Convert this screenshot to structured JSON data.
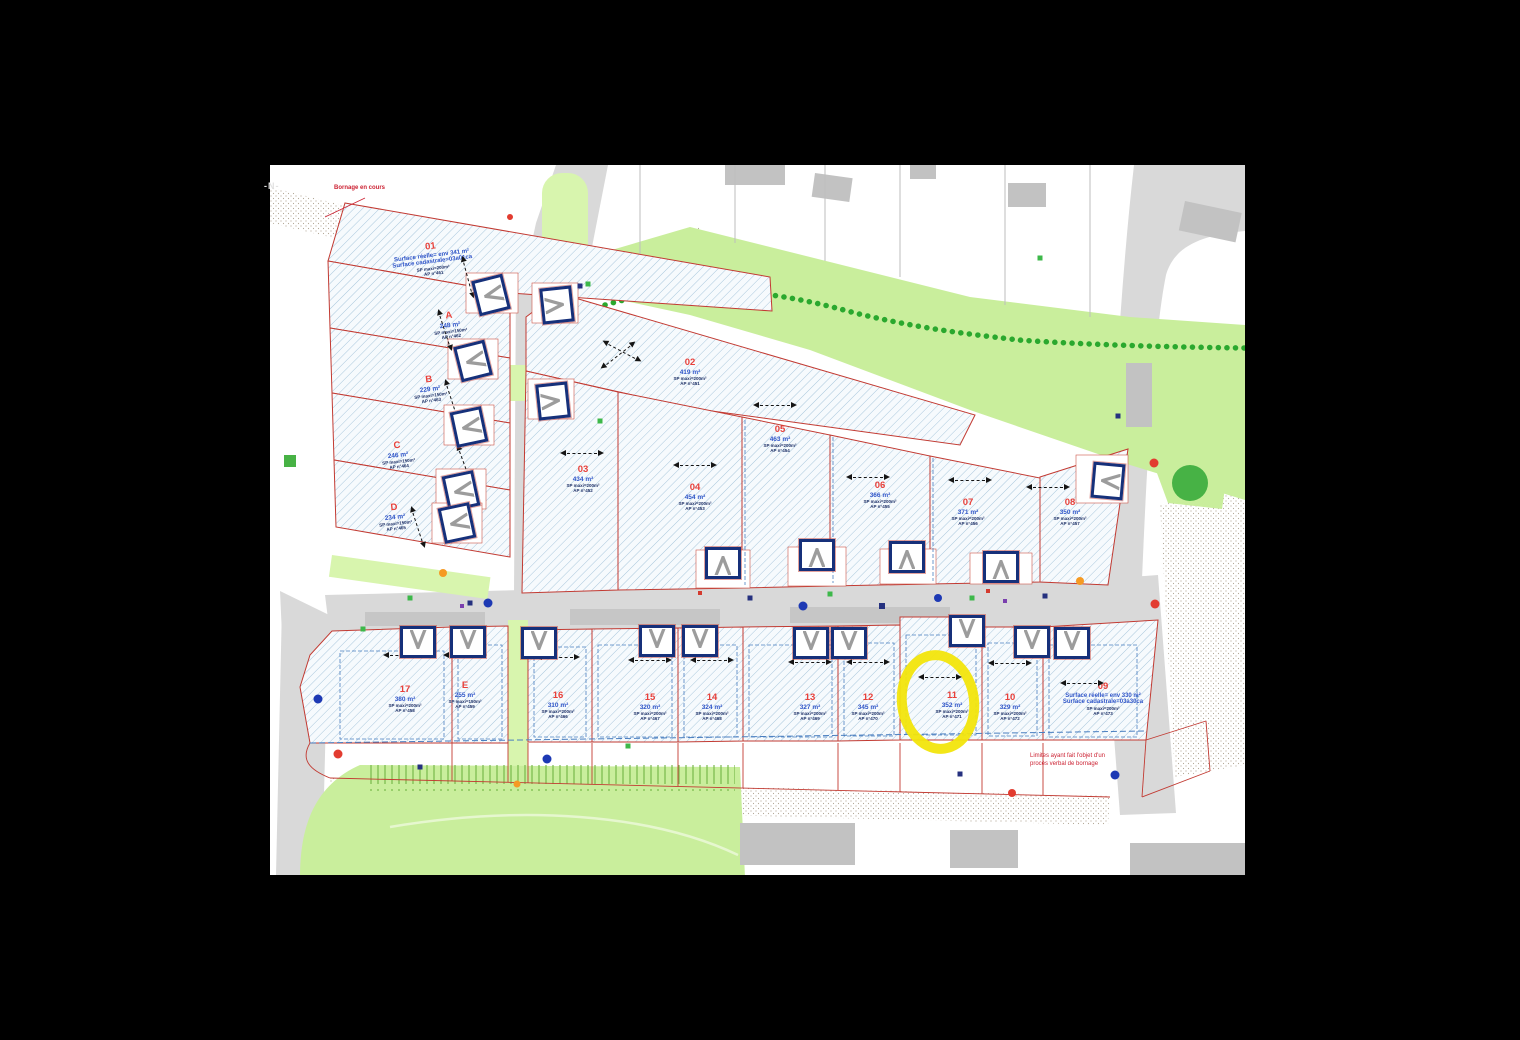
{
  "colors": {
    "bg": "#000000",
    "map_bg": "#ffffff",
    "hatch": "#a9c7dc",
    "lot_fill": "#f6fafd",
    "lot_border": "#c23a32",
    "road": "#d9d9d9",
    "road_dark": "#c6c6c6",
    "green": "#c9ee9c",
    "green_light": "#d8f5ae",
    "hedge": "#2aa82e",
    "tree": "#47b245",
    "navy": "#16307a",
    "label_red": "#e8403a",
    "label_blue": "#2f55c8",
    "tiny_navy": "#1c2f66",
    "chip_blue": "#1d3bb0",
    "dim_red": "#cc2233",
    "yellow": "#f2e50c",
    "stipple": "#b3a998",
    "blue_dash": "#4a7fc0"
  },
  "annotations": {
    "north": "-N-",
    "bornage": "Bornage en cours",
    "limites": "Limites ayant fait l'objet d'un procès verbal de bornage"
  },
  "lots": [
    {
      "id": "01",
      "area": "Surface réelle= env 341 m²",
      "area2": "Surface cadastrale=03a01ca",
      "sp": "SP maxi=200m²",
      "ap": "AP n°461",
      "x": 162,
      "y": 94,
      "rot": -7,
      "cls": "wide"
    },
    {
      "id": "A",
      "area": "248 m²",
      "sp": "SP maxi=150m²",
      "ap": "AP n°462",
      "x": 180,
      "y": 160,
      "rot": -7
    },
    {
      "id": "B",
      "area": "229 m²",
      "sp": "SP maxi=150m²",
      "ap": "AP n°463",
      "x": 160,
      "y": 224,
      "rot": -7
    },
    {
      "id": "C",
      "area": "246 m²",
      "sp": "SP maxi=150m²",
      "ap": "AP n°464",
      "x": 128,
      "y": 290,
      "rot": -6
    },
    {
      "id": "D",
      "area": "234 m²",
      "sp": "SP maxi=150m²",
      "ap": "AP n°465",
      "x": 125,
      "y": 352,
      "rot": -6
    },
    {
      "id": "02",
      "area": "419 m²",
      "sp": "SP maxi=200m²",
      "ap": "AP n°451",
      "x": 420,
      "y": 207,
      "rot": 0
    },
    {
      "id": "03",
      "area": "434 m²",
      "sp": "SP maxi=200m²",
      "ap": "AP n°452",
      "x": 313,
      "y": 314,
      "rot": 0
    },
    {
      "id": "04",
      "area": "454 m²",
      "sp": "SP maxi=200m²",
      "ap": "AP n°453",
      "x": 425,
      "y": 332,
      "rot": 0
    },
    {
      "id": "05",
      "area": "463 m²",
      "sp": "SP maxi=200m²",
      "ap": "AP n°454",
      "x": 510,
      "y": 274,
      "rot": 0
    },
    {
      "id": "06",
      "area": "366 m²",
      "sp": "SP maxi=200m²",
      "ap": "AP n°455",
      "x": 610,
      "y": 330,
      "rot": 0
    },
    {
      "id": "07",
      "area": "371 m²",
      "sp": "SP maxi=200m²",
      "ap": "AP n°456",
      "x": 698,
      "y": 347,
      "rot": 0
    },
    {
      "id": "08",
      "area": "350 m²",
      "sp": "SP maxi=200m²",
      "ap": "AP n°457",
      "x": 800,
      "y": 347,
      "rot": 0
    },
    {
      "id": "09",
      "area": "Surface réelle= env 330 m²",
      "area2": "Surface cadastrale=03a30ca",
      "sp": "SP maxi=200m²",
      "ap": "AP n°473",
      "x": 833,
      "y": 534,
      "rot": 0,
      "cls": "wide"
    },
    {
      "id": "10",
      "area": "329 m²",
      "sp": "SP maxi=200m²",
      "ap": "AP n°472",
      "x": 740,
      "y": 542,
      "rot": 0
    },
    {
      "id": "11",
      "area": "352 m²",
      "sp": "SP maxi=200m²",
      "ap": "AP n°471",
      "x": 682,
      "y": 540,
      "rot": 0
    },
    {
      "id": "12",
      "area": "345 m²",
      "sp": "SP maxi=200m²",
      "ap": "AP n°470",
      "x": 598,
      "y": 542,
      "rot": 0
    },
    {
      "id": "13",
      "area": "327 m²",
      "sp": "SP maxi=200m²",
      "ap": "AP n°469",
      "x": 540,
      "y": 542,
      "rot": 0
    },
    {
      "id": "14",
      "area": "324 m²",
      "sp": "SP maxi=200m²",
      "ap": "AP n°468",
      "x": 442,
      "y": 542,
      "rot": 0
    },
    {
      "id": "15",
      "area": "320 m²",
      "sp": "SP maxi=200m²",
      "ap": "AP n°467",
      "x": 380,
      "y": 542,
      "rot": 0
    },
    {
      "id": "16",
      "area": "310 m²",
      "sp": "SP maxi=200m²",
      "ap": "AP n°466",
      "x": 288,
      "y": 540,
      "rot": 0
    },
    {
      "id": "E",
      "area": "255 m²",
      "sp": "SP maxi=150m²",
      "ap": "AP n°459",
      "x": 195,
      "y": 530,
      "rot": 0
    },
    {
      "id": "17",
      "area": "380 m²",
      "sp": "SP maxi=200m²",
      "ap": "AP n°458",
      "x": 135,
      "y": 534,
      "rot": 0
    }
  ],
  "arrows": [
    {
      "x": 198,
      "y": 112,
      "rot": 75
    },
    {
      "x": 175,
      "y": 165,
      "rot": 72
    },
    {
      "x": 182,
      "y": 235,
      "rot": 72
    },
    {
      "x": 195,
      "y": 300,
      "rot": 70
    },
    {
      "x": 148,
      "y": 362,
      "rot": 72
    },
    {
      "x": 352,
      "y": 186,
      "rot": 28
    },
    {
      "x": 348,
      "y": 190,
      "rot": -38
    },
    {
      "x": 312,
      "y": 288,
      "rot": 0
    },
    {
      "x": 425,
      "y": 300,
      "rot": 0
    },
    {
      "x": 505,
      "y": 240,
      "rot": 0
    },
    {
      "x": 598,
      "y": 312,
      "rot": 0
    },
    {
      "x": 700,
      "y": 315,
      "rot": 0
    },
    {
      "x": 778,
      "y": 322,
      "rot": 0
    },
    {
      "x": 135,
      "y": 490,
      "rot": 0
    },
    {
      "x": 195,
      "y": 490,
      "rot": 0
    },
    {
      "x": 288,
      "y": 492,
      "rot": 0
    },
    {
      "x": 380,
      "y": 495,
      "rot": 0
    },
    {
      "x": 442,
      "y": 495,
      "rot": 0
    },
    {
      "x": 540,
      "y": 497,
      "rot": 0
    },
    {
      "x": 598,
      "y": 497,
      "rot": 0
    },
    {
      "x": 670,
      "y": 512,
      "rot": 0
    },
    {
      "x": 740,
      "y": 498,
      "rot": 0
    },
    {
      "x": 812,
      "y": 518,
      "rot": 0
    }
  ],
  "garages": [
    {
      "x": 221,
      "y": 130,
      "rot": 76
    },
    {
      "x": 203,
      "y": 196,
      "rot": 76
    },
    {
      "x": 199,
      "y": 262,
      "rot": 78
    },
    {
      "x": 191,
      "y": 326,
      "rot": 78
    },
    {
      "x": 187,
      "y": 358,
      "rot": 78
    },
    {
      "x": 287,
      "y": 140,
      "rot": 264
    },
    {
      "x": 283,
      "y": 236,
      "rot": 264
    },
    {
      "x": 453,
      "y": 398,
      "rot": 180
    },
    {
      "x": 547,
      "y": 390,
      "rot": 180
    },
    {
      "x": 637,
      "y": 392,
      "rot": 180
    },
    {
      "x": 731,
      "y": 402,
      "rot": 180
    },
    {
      "x": 838,
      "y": 316,
      "rot": 95
    },
    {
      "x": 148,
      "y": 477,
      "rot": 0
    },
    {
      "x": 198,
      "y": 477,
      "rot": 0
    },
    {
      "x": 269,
      "y": 478,
      "rot": 0
    },
    {
      "x": 387,
      "y": 476,
      "rot": 0
    },
    {
      "x": 430,
      "y": 476,
      "rot": 0
    },
    {
      "x": 541,
      "y": 478,
      "rot": 0
    },
    {
      "x": 579,
      "y": 478,
      "rot": 0
    },
    {
      "x": 697,
      "y": 466,
      "rot": 0
    },
    {
      "x": 762,
      "y": 477,
      "rot": 0
    },
    {
      "x": 802,
      "y": 478,
      "rot": 0
    }
  ],
  "dots": [
    {
      "x": 218,
      "y": 438,
      "c": "#1d39b4",
      "r": 9
    },
    {
      "x": 533,
      "y": 441,
      "c": "#1d39b4",
      "r": 9
    },
    {
      "x": 277,
      "y": 594,
      "c": "#1d39b4",
      "r": 9
    },
    {
      "x": 48,
      "y": 534,
      "c": "#1d39b4",
      "r": 9
    },
    {
      "x": 845,
      "y": 610,
      "c": "#1d39b4",
      "r": 9
    },
    {
      "x": 668,
      "y": 433,
      "c": "#1d39b4",
      "r": 8
    },
    {
      "x": 885,
      "y": 439,
      "c": "#e23c30",
      "r": 9
    },
    {
      "x": 68,
      "y": 589,
      "c": "#e23c30",
      "r": 9
    },
    {
      "x": 884,
      "y": 298,
      "c": "#e23c30",
      "r": 9
    },
    {
      "x": 742,
      "y": 628,
      "c": "#e23c30",
      "r": 8
    },
    {
      "x": 240,
      "y": 52,
      "c": "#e23c30",
      "r": 6
    },
    {
      "x": 173,
      "y": 408,
      "c": "#f59a23",
      "r": 8
    },
    {
      "x": 810,
      "y": 416,
      "c": "#f59a23",
      "r": 8
    },
    {
      "x": 247,
      "y": 619,
      "c": "#f59a23",
      "r": 7
    },
    {
      "x": 140,
      "y": 433,
      "c": "#3db84a",
      "r": 5,
      "cls": "sq"
    },
    {
      "x": 330,
      "y": 256,
      "c": "#3db84a",
      "r": 5,
      "cls": "sq"
    },
    {
      "x": 358,
      "y": 581,
      "c": "#3db84a",
      "r": 5,
      "cls": "sq"
    },
    {
      "x": 560,
      "y": 429,
      "c": "#3db84a",
      "r": 5,
      "cls": "sq"
    },
    {
      "x": 702,
      "y": 433,
      "c": "#3db84a",
      "r": 5,
      "cls": "sq"
    },
    {
      "x": 93,
      "y": 464,
      "c": "#3db84a",
      "r": 5,
      "cls": "sq"
    },
    {
      "x": 318,
      "y": 119,
      "c": "#3db84a",
      "r": 5,
      "cls": "sq"
    },
    {
      "x": 770,
      "y": 93,
      "c": "#3db84a",
      "r": 5,
      "cls": "sq"
    },
    {
      "x": 200,
      "y": 438,
      "c": "#25317f",
      "r": 5,
      "cls": "sq"
    },
    {
      "x": 480,
      "y": 433,
      "c": "#25317f",
      "r": 5,
      "cls": "sq"
    },
    {
      "x": 612,
      "y": 441,
      "c": "#25317f",
      "r": 6,
      "cls": "sq"
    },
    {
      "x": 775,
      "y": 431,
      "c": "#25317f",
      "r": 5,
      "cls": "sq"
    },
    {
      "x": 848,
      "y": 251,
      "c": "#25317f",
      "r": 5,
      "cls": "sq"
    },
    {
      "x": 150,
      "y": 602,
      "c": "#25317f",
      "r": 5,
      "cls": "sq"
    },
    {
      "x": 690,
      "y": 609,
      "c": "#25317f",
      "r": 5,
      "cls": "sq"
    },
    {
      "x": 310,
      "y": 121,
      "c": "#25317f",
      "r": 5,
      "cls": "sq"
    },
    {
      "x": 192,
      "y": 441,
      "c": "#7a3fae",
      "r": 4,
      "cls": "sq"
    },
    {
      "x": 735,
      "y": 436,
      "c": "#7a3fae",
      "r": 4,
      "cls": "sq"
    },
    {
      "x": 430,
      "y": 428,
      "c": "#d43a2e",
      "r": 4,
      "cls": "sq"
    },
    {
      "x": 718,
      "y": 426,
      "c": "#d43a2e",
      "r": 4,
      "cls": "sq"
    }
  ],
  "point_labels": [
    {
      "t": "B.274",
      "x": 195,
      "y": 56,
      "cls": "chip"
    },
    {
      "t": "B.209",
      "x": 332,
      "y": 119,
      "cls": "chip"
    },
    {
      "t": "B.214",
      "x": 400,
      "y": 158,
      "cls": "chip"
    },
    {
      "t": "B.219",
      "x": 463,
      "y": 183,
      "cls": "chip"
    },
    {
      "t": "B.224",
      "x": 529,
      "y": 206,
      "cls": "chip"
    },
    {
      "t": "B.229",
      "x": 587,
      "y": 229,
      "cls": "chip"
    },
    {
      "t": "B.234",
      "x": 646,
      "y": 253,
      "cls": "chip"
    },
    {
      "t": "B.213",
      "x": 838,
      "y": 191,
      "cls": "chip"
    },
    {
      "t": "B.270",
      "x": 906,
      "y": 409
    },
    {
      "t": "B.271",
      "x": 926,
      "y": 399
    },
    {
      "t": "B.272",
      "x": 940,
      "y": 379
    },
    {
      "t": "B.279",
      "x": 899,
      "y": 449
    },
    {
      "t": "B.233",
      "x": 118,
      "y": 478
    },
    {
      "t": "B.234",
      "x": 96,
      "y": 501
    },
    {
      "t": "B.235",
      "x": 86,
      "y": 523
    },
    {
      "t": "B.236",
      "x": 73,
      "y": 609
    },
    {
      "t": "B.237",
      "x": 153,
      "y": 609
    },
    {
      "t": "B.240",
      "x": 333,
      "y": 614
    },
    {
      "t": "B.241",
      "x": 407,
      "y": 618
    },
    {
      "t": "B.242",
      "x": 485,
      "y": 620
    },
    {
      "t": "B.243",
      "x": 543,
      "y": 622
    },
    {
      "t": "B.244",
      "x": 635,
      "y": 621
    },
    {
      "t": "B.245",
      "x": 712,
      "y": 619
    },
    {
      "t": "B.246",
      "x": 767,
      "y": 618
    },
    {
      "t": "B.265",
      "x": 756,
      "y": 413
    },
    {
      "t": "B.268",
      "x": 737,
      "y": 425
    },
    {
      "t": "R.30",
      "x": 193,
      "y": 634,
      "cls": "chip"
    },
    {
      "t": "R.31",
      "x": 835,
      "y": 631,
      "cls": "chip"
    },
    {
      "t": "B.20",
      "x": 268,
      "y": 637,
      "cls": "chip"
    }
  ],
  "dim_labels": [
    {
      "t": "7.01",
      "x": 44,
      "y": 82,
      "rot": 75
    },
    {
      "t": "7.01",
      "x": 48,
      "y": 150,
      "rot": 75
    },
    {
      "t": "7.01",
      "x": 52,
      "y": 217,
      "rot": 75
    },
    {
      "t": "7.01",
      "x": 56,
      "y": 284,
      "rot": 75
    },
    {
      "t": "2.50",
      "x": 38,
      "y": 120,
      "rot": 75
    },
    {
      "t": "19.98",
      "x": 268,
      "y": 72,
      "rot": -15
    },
    {
      "t": "23.04",
      "x": 160,
      "y": 58,
      "rot": -10
    },
    {
      "t": "25.02",
      "x": 150,
      "y": 130,
      "rot": 8
    },
    {
      "t": "25.04",
      "x": 148,
      "y": 198,
      "rot": 8
    },
    {
      "t": "25.05",
      "x": 150,
      "y": 264,
      "rot": 8
    },
    {
      "t": "25.06",
      "x": 152,
      "y": 332,
      "rot": 8
    },
    {
      "t": "12.48",
      "x": 420,
      "y": 252,
      "rot": 12
    },
    {
      "t": "10.05",
      "x": 502,
      "y": 264,
      "rot": 10
    },
    {
      "t": "13.05",
      "x": 372,
      "y": 140,
      "rot": 18
    },
    {
      "t": "35.30",
      "x": 352,
      "y": 335,
      "rot": 90
    },
    {
      "t": "16.97",
      "x": 115,
      "y": 600,
      "rot": 1
    },
    {
      "t": "13.05",
      "x": 200,
      "y": 601,
      "rot": 1
    },
    {
      "t": "12.00",
      "x": 370,
      "y": 616,
      "rot": 2
    },
    {
      "t": "13.00",
      "x": 440,
      "y": 618,
      "rot": 2
    },
    {
      "t": "13.05",
      "x": 510,
      "y": 620,
      "rot": 2
    },
    {
      "t": "2.10",
      "x": 575,
      "y": 622,
      "rot": 2
    },
    {
      "t": "8.60",
      "x": 645,
      "y": 624,
      "rot": 2
    },
    {
      "t": "5.05",
      "x": 690,
      "y": 602,
      "rot": 0
    },
    {
      "t": "4.86",
      "x": 790,
      "y": 629,
      "rot": 3
    },
    {
      "t": "3.10",
      "x": 60,
      "y": 572,
      "rot": 80
    },
    {
      "t": "6.95",
      "x": 878,
      "y": 520,
      "rot": 85
    },
    {
      "t": "25.08",
      "x": 208,
      "y": 520,
      "rot": 90,
      "cls": "bdim"
    },
    {
      "t": "25.05",
      "x": 325,
      "y": 518,
      "rot": 90,
      "cls": "bdim"
    },
    {
      "t": "24.95",
      "x": 476,
      "y": 516,
      "rot": 90,
      "cls": "bdim"
    },
    {
      "t": "25.05",
      "x": 634,
      "y": 514,
      "rot": 90,
      "cls": "bdim"
    },
    {
      "t": "23.08",
      "x": 870,
      "y": 520,
      "rot": 82,
      "cls": "bdim"
    },
    {
      "t": "20.05",
      "x": 716,
      "y": 518,
      "rot": 90,
      "cls": "bdim"
    }
  ]
}
